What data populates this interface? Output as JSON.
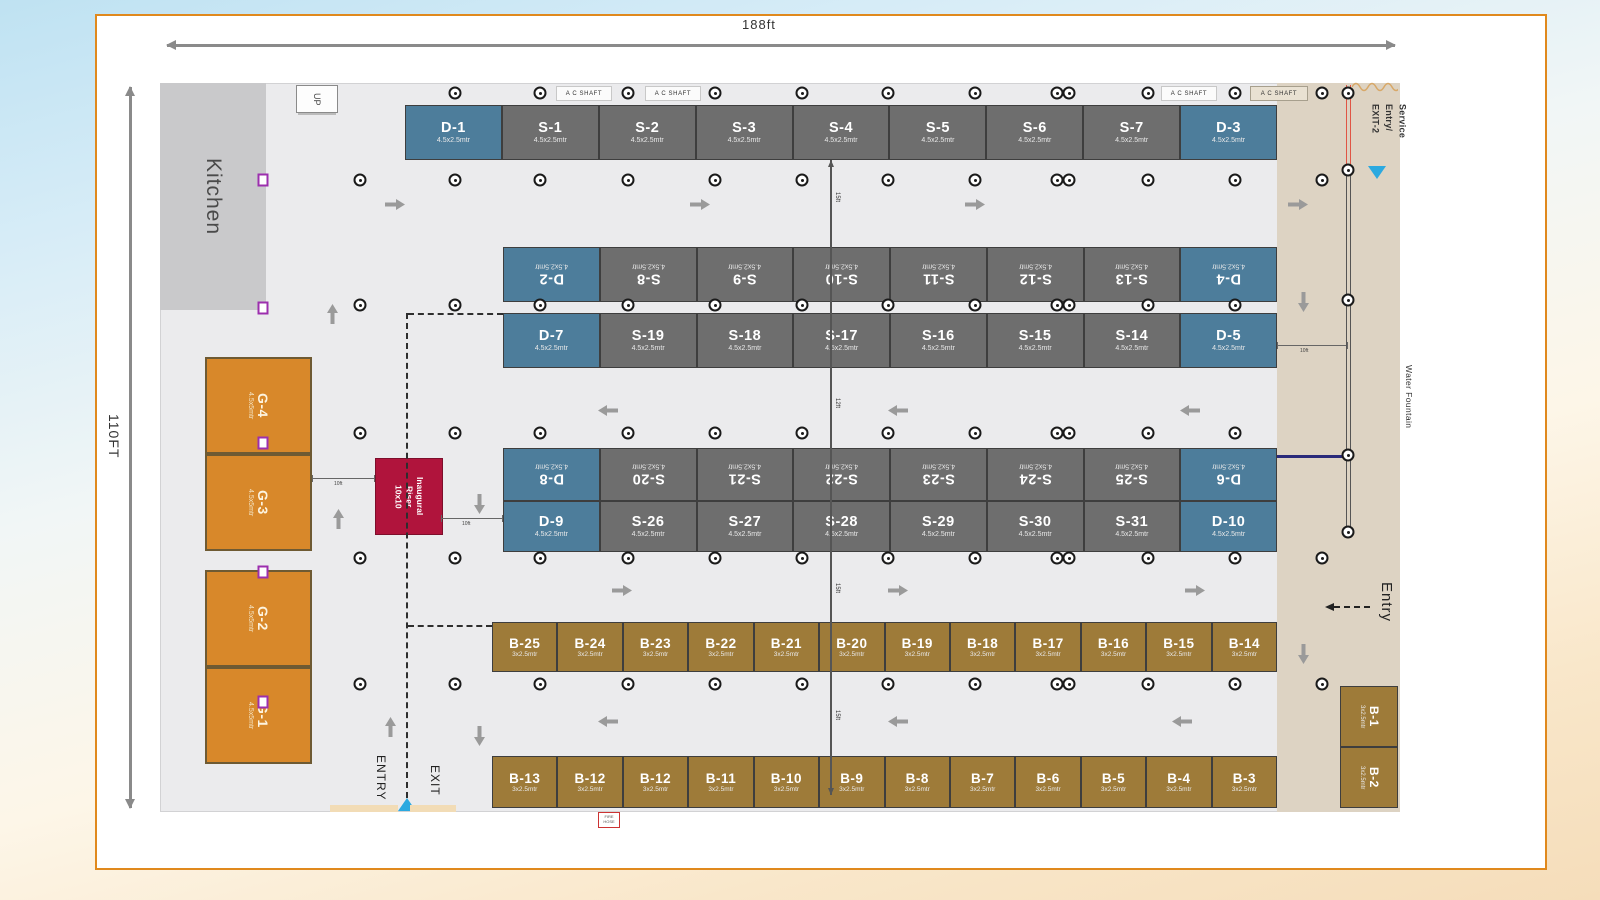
{
  "dims": {
    "width": "188ft",
    "height": "110FT"
  },
  "areas": {
    "kitchen": "Kitchen",
    "up": "UP",
    "riser": [
      "Inaugural",
      "Riser",
      "10x10"
    ],
    "service": [
      "Service",
      "Entry/",
      "EXIT-2"
    ],
    "water": "Water Fountain",
    "entry_side": "Entry",
    "entry_bottom": "ENTRY",
    "exit_bottom": "EXIT",
    "ac_shaft": "A C SHAFT",
    "fire": "FIRE HOSE"
  },
  "aisle_labels": [
    "15ft",
    "12ft",
    "15ft",
    "15ft"
  ],
  "gap_labels": [
    "10ft",
    "10ft",
    "10ft"
  ],
  "rows": {
    "row1": [
      {
        "id": "D-1",
        "size": "4.5x2.5mtr",
        "type": "d"
      },
      {
        "id": "S-1",
        "size": "4.5x2.5mtr",
        "type": "s"
      },
      {
        "id": "S-2",
        "size": "4.5x2.5mtr",
        "type": "s"
      },
      {
        "id": "S-3",
        "size": "4.5x2.5mtr",
        "type": "s"
      },
      {
        "id": "S-4",
        "size": "4.5x2.5mtr",
        "type": "s"
      },
      {
        "id": "S-5",
        "size": "4.5x2.5mtr",
        "type": "s"
      },
      {
        "id": "S-6",
        "size": "4.5x2.5mtr",
        "type": "s"
      },
      {
        "id": "S-7",
        "size": "4.5x2.5mtr",
        "type": "s"
      },
      {
        "id": "D-3",
        "size": "4.5x2.5mtr",
        "type": "d"
      }
    ],
    "row2": [
      {
        "id": "D-2",
        "size": "4.5x2.5mtr",
        "type": "d"
      },
      {
        "id": "S-8",
        "size": "4.5x2.5mtr",
        "type": "s"
      },
      {
        "id": "S-9",
        "size": "4.5x2.5mtr",
        "type": "s"
      },
      {
        "id": "S-10",
        "size": "4.5x2.5mtr",
        "type": "s"
      },
      {
        "id": "S-11",
        "size": "4.5x2.5mtr",
        "type": "s"
      },
      {
        "id": "S-12",
        "size": "4.5x2.5mtr",
        "type": "s"
      },
      {
        "id": "S-13",
        "size": "4.5x2.5mtr",
        "type": "s"
      },
      {
        "id": "D-4",
        "size": "4.5x2.5mtr",
        "type": "d"
      }
    ],
    "row3": [
      {
        "id": "D-7",
        "size": "4.5x2.5mtr",
        "type": "d"
      },
      {
        "id": "S-19",
        "size": "4.5x2.5mtr",
        "type": "s"
      },
      {
        "id": "S-18",
        "size": "4.5x2.5mtr",
        "type": "s"
      },
      {
        "id": "S-17",
        "size": "4.5x2.5mtr",
        "type": "s"
      },
      {
        "id": "S-16",
        "size": "4.5x2.5mtr",
        "type": "s"
      },
      {
        "id": "S-15",
        "size": "4.5x2.5mtr",
        "type": "s"
      },
      {
        "id": "S-14",
        "size": "4.5x2.5mtr",
        "type": "s"
      },
      {
        "id": "D-5",
        "size": "4.5x2.5mtr",
        "type": "d"
      }
    ],
    "row4": [
      {
        "id": "D-8",
        "size": "4.5x2.5mtr",
        "type": "d"
      },
      {
        "id": "S-20",
        "size": "4.5x2.5mtr",
        "type": "s"
      },
      {
        "id": "S-21",
        "size": "4.5x2.5mtr",
        "type": "s"
      },
      {
        "id": "S-22",
        "size": "4.5x2.5mtr",
        "type": "s"
      },
      {
        "id": "S-23",
        "size": "4.5x2.5mtr",
        "type": "s"
      },
      {
        "id": "S-24",
        "size": "4.5x2.5mtr",
        "type": "s"
      },
      {
        "id": "S-25",
        "size": "4.5x2.5mtr",
        "type": "s"
      },
      {
        "id": "D-6",
        "size": "4.5x2.5mtr",
        "type": "d"
      }
    ],
    "row5": [
      {
        "id": "D-9",
        "size": "4.5x2.5mtr",
        "type": "d"
      },
      {
        "id": "S-26",
        "size": "4.5x2.5mtr",
        "type": "s"
      },
      {
        "id": "S-27",
        "size": "4.5x2.5mtr",
        "type": "s"
      },
      {
        "id": "S-28",
        "size": "4.5x2.5mtr",
        "type": "s"
      },
      {
        "id": "S-29",
        "size": "4.5x2.5mtr",
        "type": "s"
      },
      {
        "id": "S-30",
        "size": "4.5x2.5mtr",
        "type": "s"
      },
      {
        "id": "S-31",
        "size": "4.5x2.5mtr",
        "type": "s"
      },
      {
        "id": "D-10",
        "size": "4.5x2.5mtr",
        "type": "d"
      }
    ],
    "brow1": [
      {
        "id": "B-25",
        "size": "3x2.5mtr",
        "type": "b"
      },
      {
        "id": "B-24",
        "size": "3x2.5mtr",
        "type": "b"
      },
      {
        "id": "B-23",
        "size": "3x2.5mtr",
        "type": "b"
      },
      {
        "id": "B-22",
        "size": "3x2.5mtr",
        "type": "b"
      },
      {
        "id": "B-21",
        "size": "3x2.5mtr",
        "type": "b"
      },
      {
        "id": "B-20",
        "size": "3x2.5mtr",
        "type": "b"
      },
      {
        "id": "B-19",
        "size": "3x2.5mtr",
        "type": "b"
      },
      {
        "id": "B-18",
        "size": "3x2.5mtr",
        "type": "b"
      },
      {
        "id": "B-17",
        "size": "3x2.5mtr",
        "type": "b"
      },
      {
        "id": "B-16",
        "size": "3x2.5mtr",
        "type": "b"
      },
      {
        "id": "B-15",
        "size": "3x2.5mtr",
        "type": "b"
      },
      {
        "id": "B-14",
        "size": "3x2.5mtr",
        "type": "b"
      }
    ],
    "brow2": [
      {
        "id": "B-13",
        "size": "3x2.5mtr",
        "type": "b"
      },
      {
        "id": "B-12",
        "size": "3x2.5mtr",
        "type": "b"
      },
      {
        "id": "B-12",
        "size": "3x2.5mtr",
        "type": "b"
      },
      {
        "id": "B-11",
        "size": "3x2.5mtr",
        "type": "b"
      },
      {
        "id": "B-10",
        "size": "3x2.5mtr",
        "type": "b"
      },
      {
        "id": "B-9",
        "size": "3x2.5mtr",
        "type": "b"
      },
      {
        "id": "B-8",
        "size": "3x2.5mtr",
        "type": "b"
      },
      {
        "id": "B-7",
        "size": "3x2.5mtr",
        "type": "b"
      },
      {
        "id": "B-6",
        "size": "3x2.5mtr",
        "type": "b"
      },
      {
        "id": "B-5",
        "size": "3x2.5mtr",
        "type": "b"
      },
      {
        "id": "B-4",
        "size": "3x2.5mtr",
        "type": "b"
      },
      {
        "id": "B-3",
        "size": "3x2.5mtr",
        "type": "b"
      }
    ],
    "gcol": [
      {
        "id": "G-4",
        "size": "4.5x5mtr",
        "type": "g"
      },
      {
        "id": "G-3",
        "size": "4.5x5mtr",
        "type": "g"
      },
      {
        "id": "G-2",
        "size": "4.5x5mtr",
        "type": "g"
      },
      {
        "id": "G-1",
        "size": "4.5x5mtr",
        "type": "g"
      }
    ],
    "sideb": [
      {
        "id": "B-1",
        "size": "3x2.5mtr",
        "type": "b"
      },
      {
        "id": "B-2",
        "size": "3x2.5mtr",
        "type": "b"
      }
    ]
  },
  "colors": {
    "accent_border": "#e0891d",
    "d_booth": "#4d7d9b",
    "s_booth": "#6e6e6e",
    "b_booth": "#9e7b39",
    "g_booth": "#d8882a",
    "riser": "#b0143c",
    "marker_purple": "#9c2fae",
    "triangle_blue": "#2ba9e0",
    "service_red": "#e05545"
  }
}
